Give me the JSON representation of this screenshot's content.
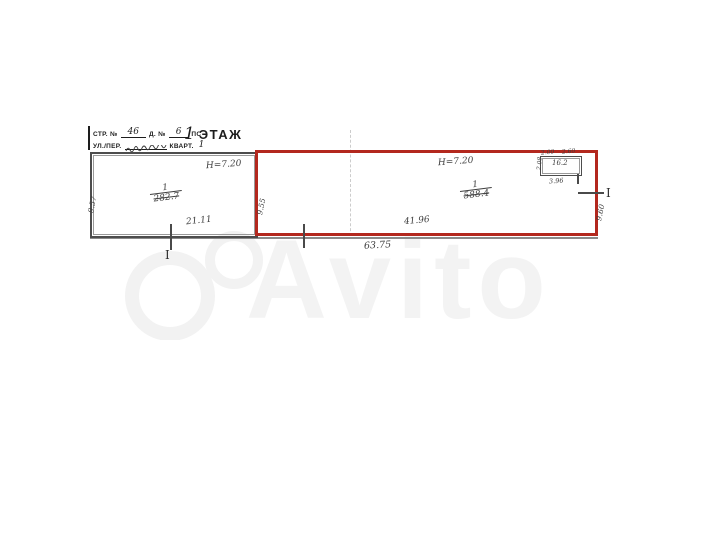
{
  "watermark": {
    "brand": "Avito"
  },
  "stamp": {
    "building_label": "СТР. №",
    "building_value": "46",
    "house_label": "Д. №",
    "house_value": "6",
    "house_suffix": "ПС",
    "street_label": "УЛ./ПЕР.",
    "quarter_label": "КВАРТ.",
    "quarter_value": "1"
  },
  "floor": {
    "number": "1",
    "label": "ЭТАЖ"
  },
  "plan": {
    "highlight_color": "#b3281e",
    "left_room": {
      "ceiling_height": "Н=7.20",
      "room_number": "1",
      "area_crossed_out": "282.7",
      "width": "21.11",
      "depth": "9.57",
      "section_marker": "I"
    },
    "highlighted_room": {
      "ceiling_height": "Н=7.20",
      "room_number": "1",
      "area_crossed_out": "588.4",
      "width": "41.96",
      "overall_width": "63.75",
      "depth_left": "9.55",
      "depth_right": "9.60",
      "section_marker": "I"
    },
    "small_room": {
      "dim_top_left": "2.00",
      "dim_top_right": "2.60",
      "depth": "2.08",
      "area": "16.2",
      "width": "3.96"
    }
  }
}
